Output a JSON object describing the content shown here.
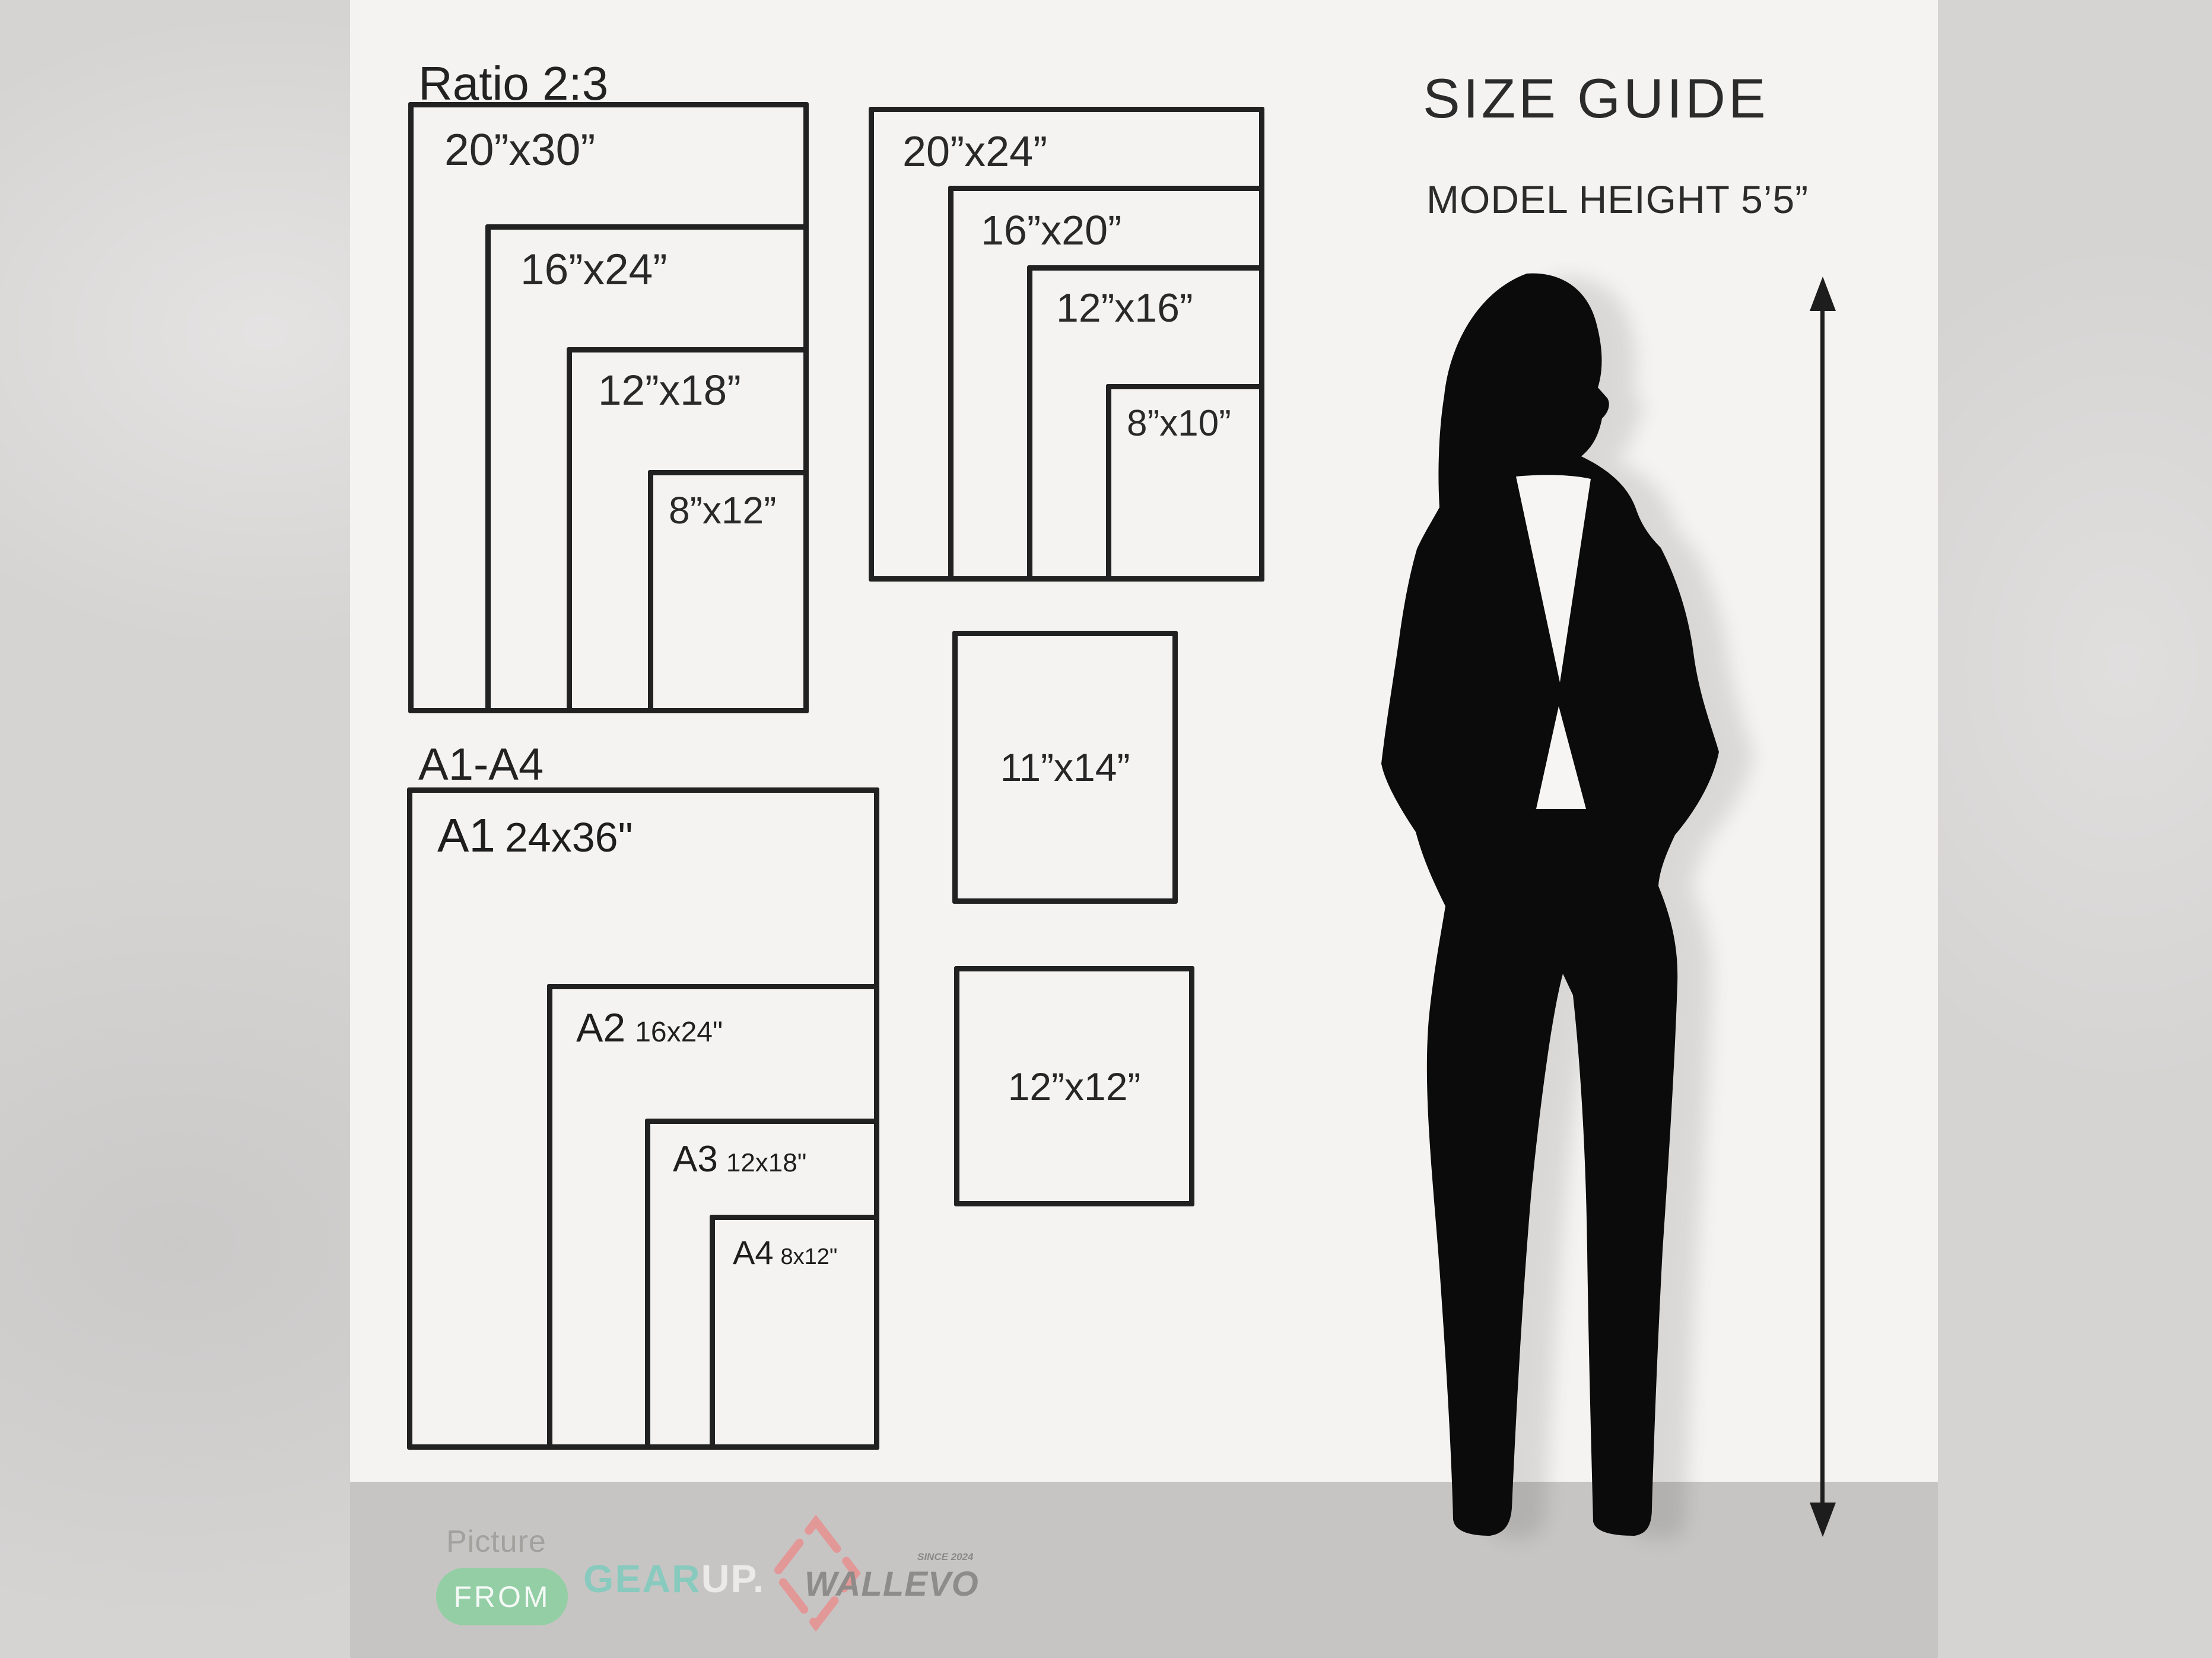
{
  "titles": {
    "size_guide": "SIZE GUIDE",
    "model_height": "MODEL HEIGHT 5’5”"
  },
  "groups": {
    "ratio23": {
      "title": "Ratio 2:3",
      "sizes": [
        "20”x30”",
        "16”x24”",
        "12”x18”",
        "8”x12”"
      ]
    },
    "standard": {
      "sizes": [
        "20”x24”",
        "16”x20”",
        "12”x16”",
        "8”x10”"
      ]
    },
    "a_series": {
      "title": "A1-A4",
      "items": [
        {
          "name": "A1",
          "size": "24x36\""
        },
        {
          "name": "A2",
          "size": "16x24\""
        },
        {
          "name": "A3",
          "size": "12x18\""
        },
        {
          "name": "A4",
          "size": "8x12\""
        }
      ]
    },
    "single": [
      "11”x14”",
      "12”x12”"
    ]
  },
  "footer": {
    "picture_label": "Picture",
    "from_label": "FROM",
    "gearup": {
      "gear": "GEAR",
      "up": "UP."
    },
    "wallevo": {
      "name": "WALLEVO",
      "since": "SINCE 2024"
    }
  },
  "colors": {
    "accent_green_pill": "#8ccf9f",
    "accent_mint_gear": "#7fccbe",
    "accent_salmon_diamond": "#e98c8c",
    "panel_white": "#f4f3f2",
    "footer_gray": "#c7c5c4",
    "line_black": "#212121"
  }
}
